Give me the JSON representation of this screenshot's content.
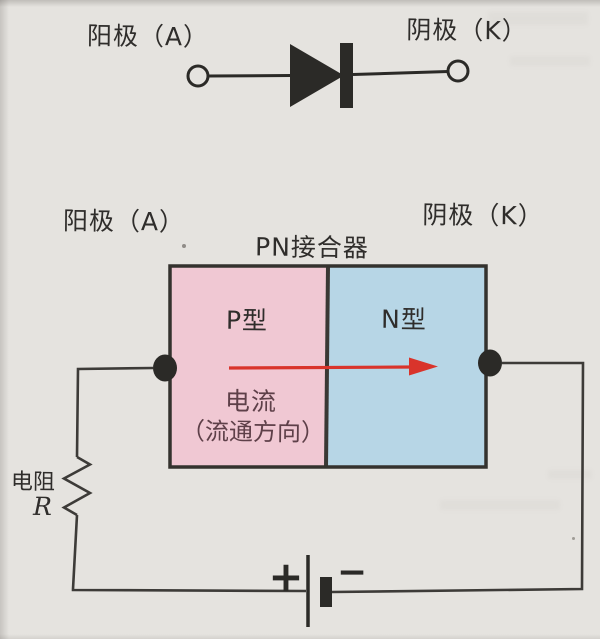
{
  "page": {
    "bg_color": "#e5e3df"
  },
  "colors": {
    "ink": "#2b2a27",
    "wire": "#3d3b38",
    "box_border": "#34322e",
    "junction_line": "#3a3834",
    "p_region": "#f0c8d3",
    "n_region": "#b7d6e6",
    "arrow_red": "#d9342b",
    "label_text": "#2f2d2b",
    "current_text": "#5e4049"
  },
  "diode_symbol": {
    "anode_label": "阳极（A）",
    "cathode_label": "阴极（K）"
  },
  "pn_junction": {
    "title": "PN接合器",
    "anode_label": "阳极（A）",
    "cathode_label": "阴极（K）",
    "p_type_label": "P型",
    "n_type_label": "N型",
    "current_label": "电流",
    "flow_direction_label": "（流通方向）"
  },
  "circuit": {
    "resistor_label": "电阻",
    "resistor_symbol": "R",
    "battery_positive": "+",
    "battery_negative": "−"
  }
}
